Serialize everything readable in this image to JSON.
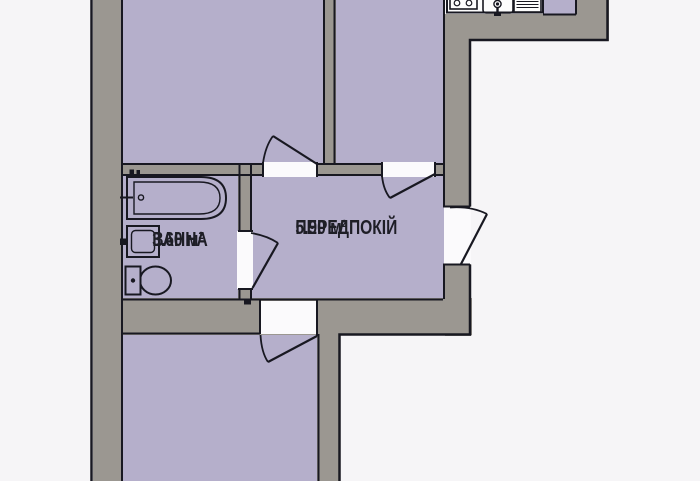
{
  "plan": {
    "labels": {
      "hallway": {
        "name": "ПЕРЕДПОКІЙ",
        "area": "5.90 м²"
      },
      "bathroom": {
        "name": "ВАННА",
        "area": "3.60 м²"
      }
    },
    "fixtures": [
      "bathtub",
      "bathtub-faucet",
      "washbasin",
      "toilet",
      "kitchen-stove",
      "kitchen-sink",
      "kitchen-faucet",
      "dish-drainer"
    ],
    "colors": {
      "background": "#f6f5f7",
      "room_fill": "#b5afcb",
      "wall_fill": "#9b9791",
      "outline": "#181821",
      "doorway": "#fbfafc",
      "counter": "#fdfdfd",
      "label_text": "#1e1e26"
    }
  }
}
